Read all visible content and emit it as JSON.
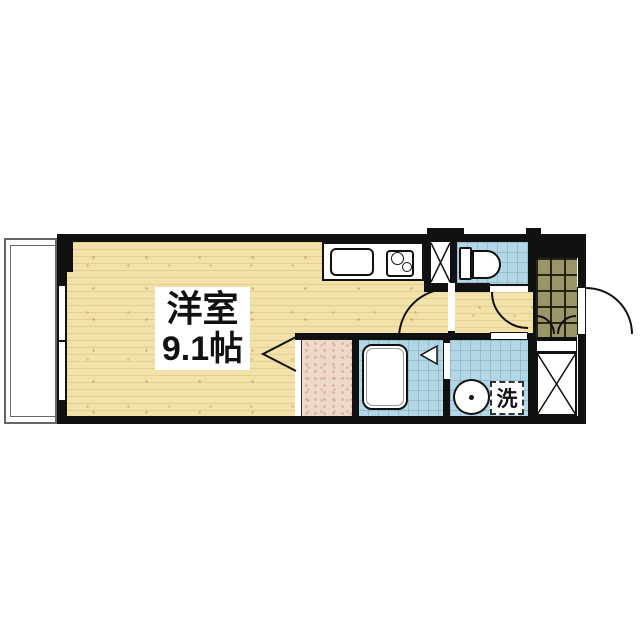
{
  "floorplan": {
    "room_label": {
      "line1": "洋室",
      "line2": "9.1帖"
    },
    "washer_label": "洗",
    "palette": {
      "background": "#ffffff",
      "wall": "#111111",
      "wood_floor": "#f2e2aa",
      "wet_area_tile": "#b4d7e6",
      "entrance_tile": "#9c9569",
      "closet_floor": "#eed9ca",
      "outline": "#111111",
      "balcony_line": "#666666"
    },
    "fixtures": [
      "balcony",
      "sliding-window",
      "kitchen-counter",
      "kitchen-sink",
      "stove-two-burners",
      "storage-x-box",
      "toilet",
      "entrance-tiled-floor",
      "entrance-door-swing",
      "shoe-storage-double-doors",
      "hallway",
      "closet-folding-door",
      "bathtub",
      "bathroom-folding-door",
      "washbasin",
      "washing-machine-space",
      "pipe-space-x-box"
    ]
  }
}
